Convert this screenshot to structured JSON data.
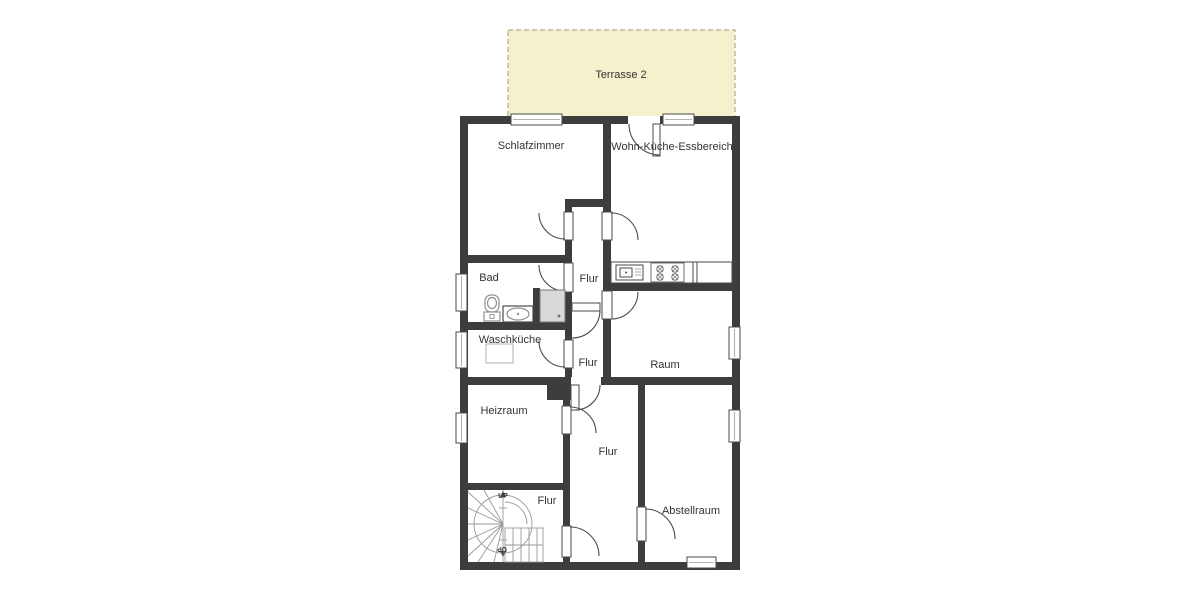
{
  "plan": {
    "terrace": {
      "label": "Terrasse 2"
    },
    "rooms": {
      "schlafzimmer": {
        "label": "Schlafzimmer"
      },
      "wohn_kueche_essbereich": {
        "label": "Wohn-Küche-Essbereich"
      },
      "bad": {
        "label": "Bad"
      },
      "flur_top": {
        "label": "Flur"
      },
      "waschkueche": {
        "label": "Waschküche"
      },
      "flur_middle": {
        "label": "Flur"
      },
      "raum": {
        "label": "Raum"
      },
      "heizraum": {
        "label": "Heizraum"
      },
      "flur_bottom": {
        "label": "Flur"
      },
      "flur_stairs": {
        "label": "Flur"
      },
      "abstellraum": {
        "label": "Abstellraum"
      }
    },
    "stairs": {
      "up": "UP",
      "down": "UP"
    },
    "colors": {
      "wall": "#3d3d3d",
      "terrace_fill": "#f6f1cd",
      "terrace_border": "#bcbc9e",
      "door_swing": "#4a4a4a",
      "fixture": "#8f8f8f",
      "label_text": "#333333"
    }
  }
}
